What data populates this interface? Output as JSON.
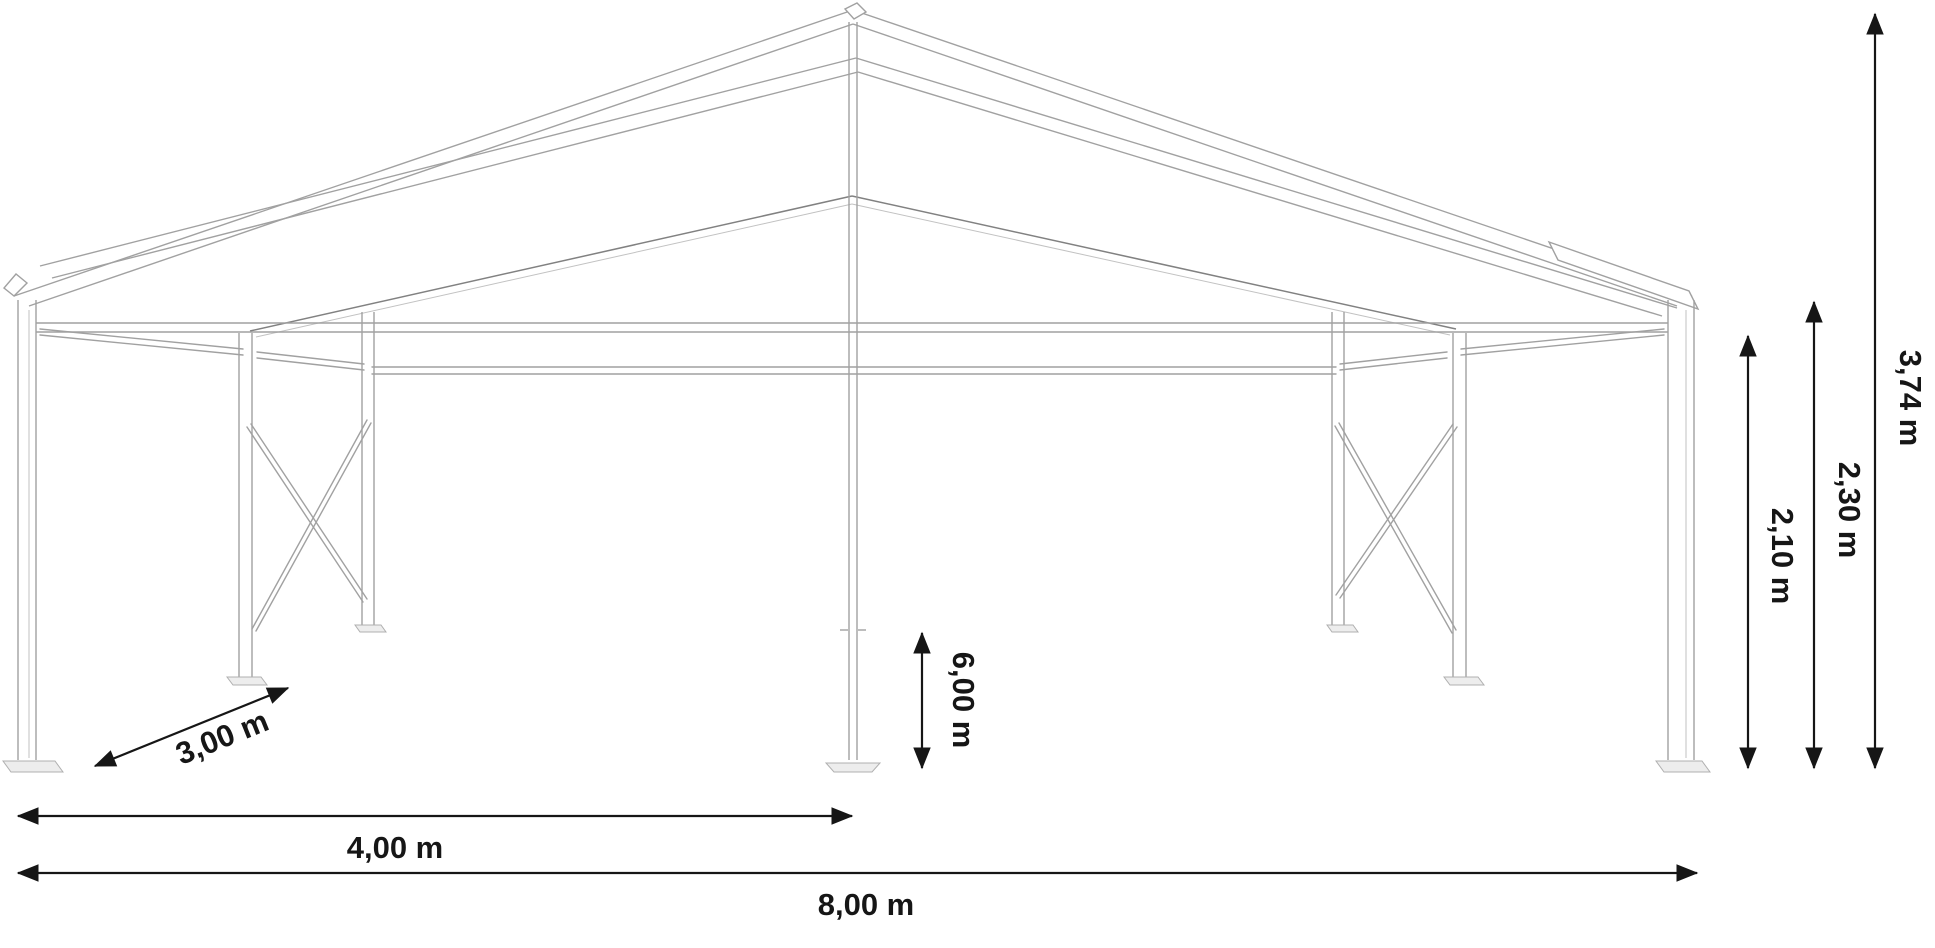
{
  "diagram": {
    "type": "tent-frame-technical-drawing",
    "dimensions": {
      "bay": {
        "label": "3,00 m",
        "meaning": "bay depth (diagonal ground arrow)"
      },
      "half_width": {
        "label": "4,00 m",
        "meaning": "distance to centre pole"
      },
      "width": {
        "label": "8,00 m",
        "meaning": "total width"
      },
      "length": {
        "label": "6,00 m",
        "meaning": "vertical arrow at centre pole"
      },
      "leg_height": {
        "label": "2,10 m",
        "meaning": "side post height"
      },
      "eave_height": {
        "label": "2,30 m",
        "meaning": "eave height"
      },
      "ridge_height": {
        "label": "3,74 m",
        "meaning": "ridge height"
      }
    },
    "colors": {
      "background": "#ffffff",
      "structure": "#a1a1a1",
      "structure_dark": "#818181",
      "plate_fill": "#ededed",
      "plate_stroke": "#b0b0b0",
      "dimension": "#161616"
    }
  }
}
